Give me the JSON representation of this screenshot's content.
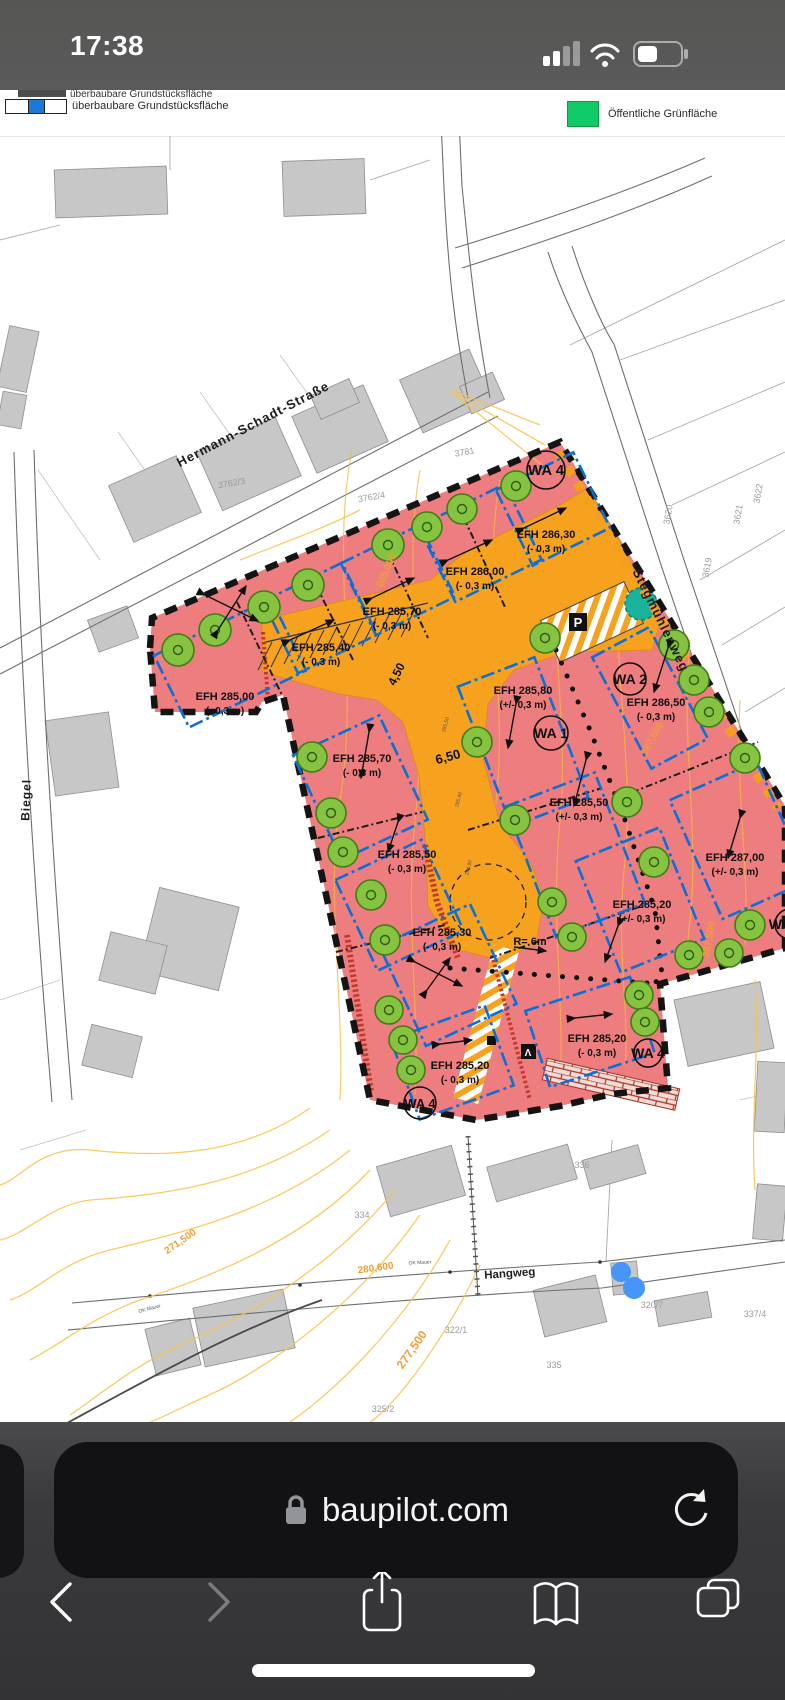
{
  "status_bar": {
    "time": "17:38"
  },
  "legend": {
    "clipped_label": "überbaubare Grundstücksfläche",
    "item_left": "überbaubare Grundstücksfläche",
    "item_right": "Öffentliche Grünfläche",
    "green_swatch_color": "#10c967"
  },
  "map": {
    "street_labels": {
      "hermann_schadt": "Hermann-Schadt-Straße",
      "stegmuehlenweg": "Stegmühlenweg",
      "biegel": "Biegel",
      "hangweg": "Hangweg"
    },
    "zone_labels": {
      "wa1": "WA 1",
      "wa2": "WA 2",
      "wa4": "WA 4",
      "wa_partial": "WA"
    },
    "efh_labels": [
      {
        "name": "EFH 285,00",
        "tol": "(- 0,3 m)"
      },
      {
        "name": "EFH 285,40",
        "tol": "(- 0,3 m)"
      },
      {
        "name": "EFH 285,70",
        "tol": "(- 0,3 m)"
      },
      {
        "name": "EFH 286,00",
        "tol": "(- 0,3 m)"
      },
      {
        "name": "EFH 286,30",
        "tol": "(- 0,3 m)"
      },
      {
        "name": "EFH 285,80",
        "tol": "(+/- 0,3 m)"
      },
      {
        "name": "EFH 286,50",
        "tol": "(- 0,3 m)"
      },
      {
        "name": "EFH 285,70",
        "tol": "(- 0,3 m)"
      },
      {
        "name": "EFH 285,50",
        "tol": "(- 0,3 m)"
      },
      {
        "name": "EFH 285,50",
        "tol": "(+/- 0,3 m)"
      },
      {
        "name": "EFH 287,00",
        "tol": "(+/- 0,3 m)"
      },
      {
        "name": "EFH 285,20",
        "tol": "(+/- 0,3 m)"
      },
      {
        "name": "EFH 285,30",
        "tol": "(- 0,3 m)"
      },
      {
        "name": "EFH 285,20",
        "tol": "(- 0,3 m)"
      },
      {
        "name": "EFH 285,20",
        "tol": "(- 0,3 m)"
      }
    ],
    "road_labels": {
      "radius": "R= 6m",
      "width_a": "4,50",
      "width_b": "6,50",
      "parking": "P",
      "path_sign": "Ʌ"
    },
    "contour_labels": {
      "a": "285,000",
      "b": "287,500",
      "c": "287,500",
      "d": "277,500",
      "e": "280,600",
      "f": "271,500"
    },
    "road_elevations": [
      "285,50",
      "285,40",
      "284,90"
    ],
    "wall_labels": [
      "OK Mauer",
      "OK Mauer"
    ],
    "parcel_numbers": [
      "3781",
      "3762/3",
      "3762/4",
      "3620",
      "3621",
      "3622",
      "3619",
      "334",
      "336",
      "322/1",
      "335",
      "325/2",
      "320/7",
      "337/4"
    ]
  },
  "browser": {
    "url": "baupilot.com"
  }
}
